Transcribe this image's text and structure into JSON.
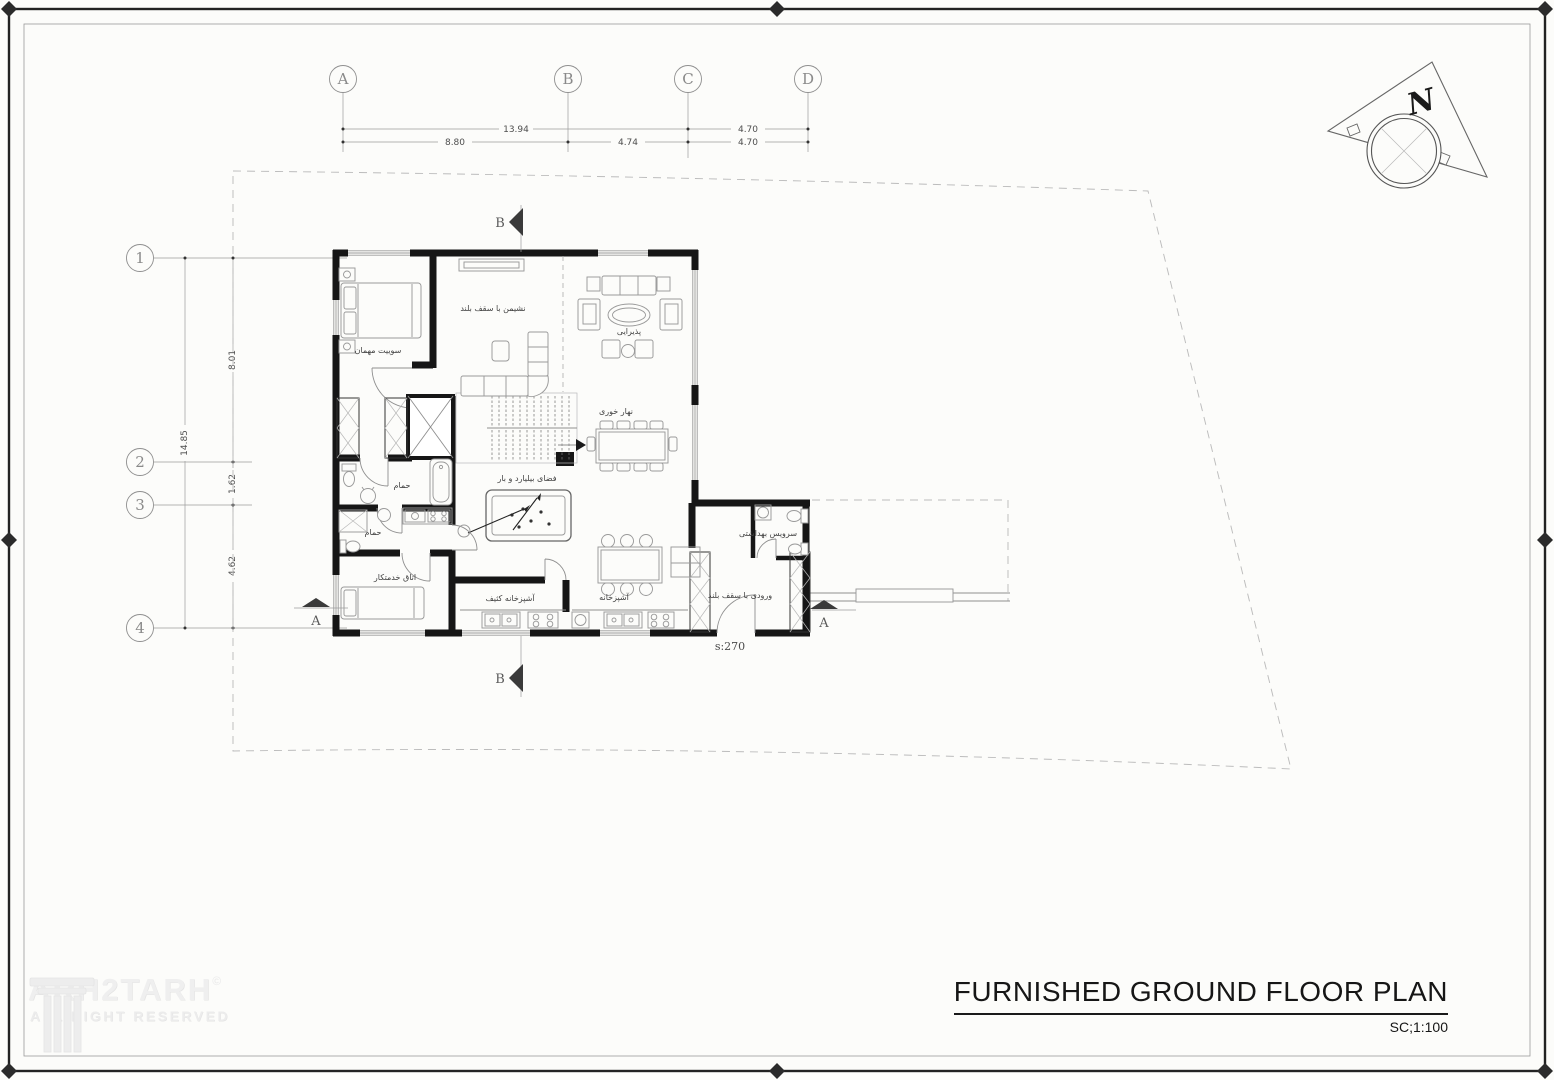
{
  "sheet": {
    "title": "FURNISHED GROUND FLOOR PLAN",
    "scale": "SC;1:100"
  },
  "north_label": "N",
  "grid": {
    "columns": [
      {
        "label": "A"
      },
      {
        "label": "B"
      },
      {
        "label": "C"
      },
      {
        "label": "D"
      }
    ],
    "rows": [
      {
        "label": "1"
      },
      {
        "label": "2"
      },
      {
        "label": "3"
      },
      {
        "label": "4"
      }
    ],
    "col_dims_upper": [
      {
        "value": "13.94"
      },
      {
        "value": "4.70"
      }
    ],
    "col_dims_lower": [
      {
        "value": "8.80"
      },
      {
        "value": "4.74"
      },
      {
        "value": "4.70"
      }
    ],
    "row_dim_total": "14.85",
    "row_dims": [
      {
        "value": "8.01"
      },
      {
        "value": "1.62"
      },
      {
        "value": "4.62"
      }
    ]
  },
  "sections": {
    "a_left": "A",
    "a_right": "A",
    "b_top": "B",
    "b_bottom": "B"
  },
  "rooms": {
    "guest_suite": "سوییت مهمان",
    "sitting_high_ceiling": "نشیمن با سقف بلند",
    "reception": "پذیرایی",
    "dining": "نهار خوری",
    "billiard_bar": "فضای بیلیارد و بار",
    "bathroom": "حمام",
    "maid_room": "اتاق خدمتکار",
    "dirty_kitchen": "آشپزخانه کثیف",
    "kitchen": "آشپزخانه",
    "wc": "سرویس بهداشتی",
    "entrance_high_ceiling": "ورودی با سقف بلند"
  },
  "annotations": {
    "entrance_area": "s:270"
  },
  "watermark": {
    "brand": "ARH2TARH",
    "copyright": "©",
    "tagline": "ALL RIGHT RESERVED"
  },
  "colors": {
    "wall": "#161616",
    "line": "#8f8f8f",
    "label": "#3f3f3f",
    "dash": "#bcbcbc"
  }
}
